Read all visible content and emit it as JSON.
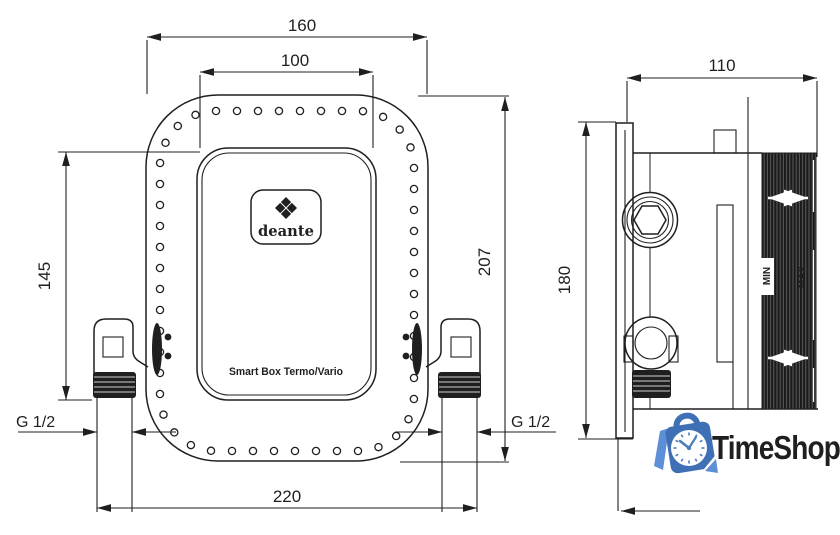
{
  "front_view": {
    "brand": "deante",
    "product_label": "Smart Box Termo/Vario",
    "dim_flange_width": "160",
    "dim_cover_width": "100",
    "dim_height_left": "145",
    "dim_height_right": "207",
    "dim_total_width": "220",
    "thread_left": "G 1/2",
    "thread_right": "G 1/2"
  },
  "side_view": {
    "dim_depth": "110",
    "dim_height": "180",
    "min_label": "MIN",
    "max_label": "MAX"
  },
  "watermark": {
    "name": "TimeShop",
    "text_blue": "#4a7dbf"
  },
  "colors": {
    "line": "#1f1f1f",
    "bag_blue": "#3f70b6",
    "accent_blue": "#5c8fd6"
  }
}
